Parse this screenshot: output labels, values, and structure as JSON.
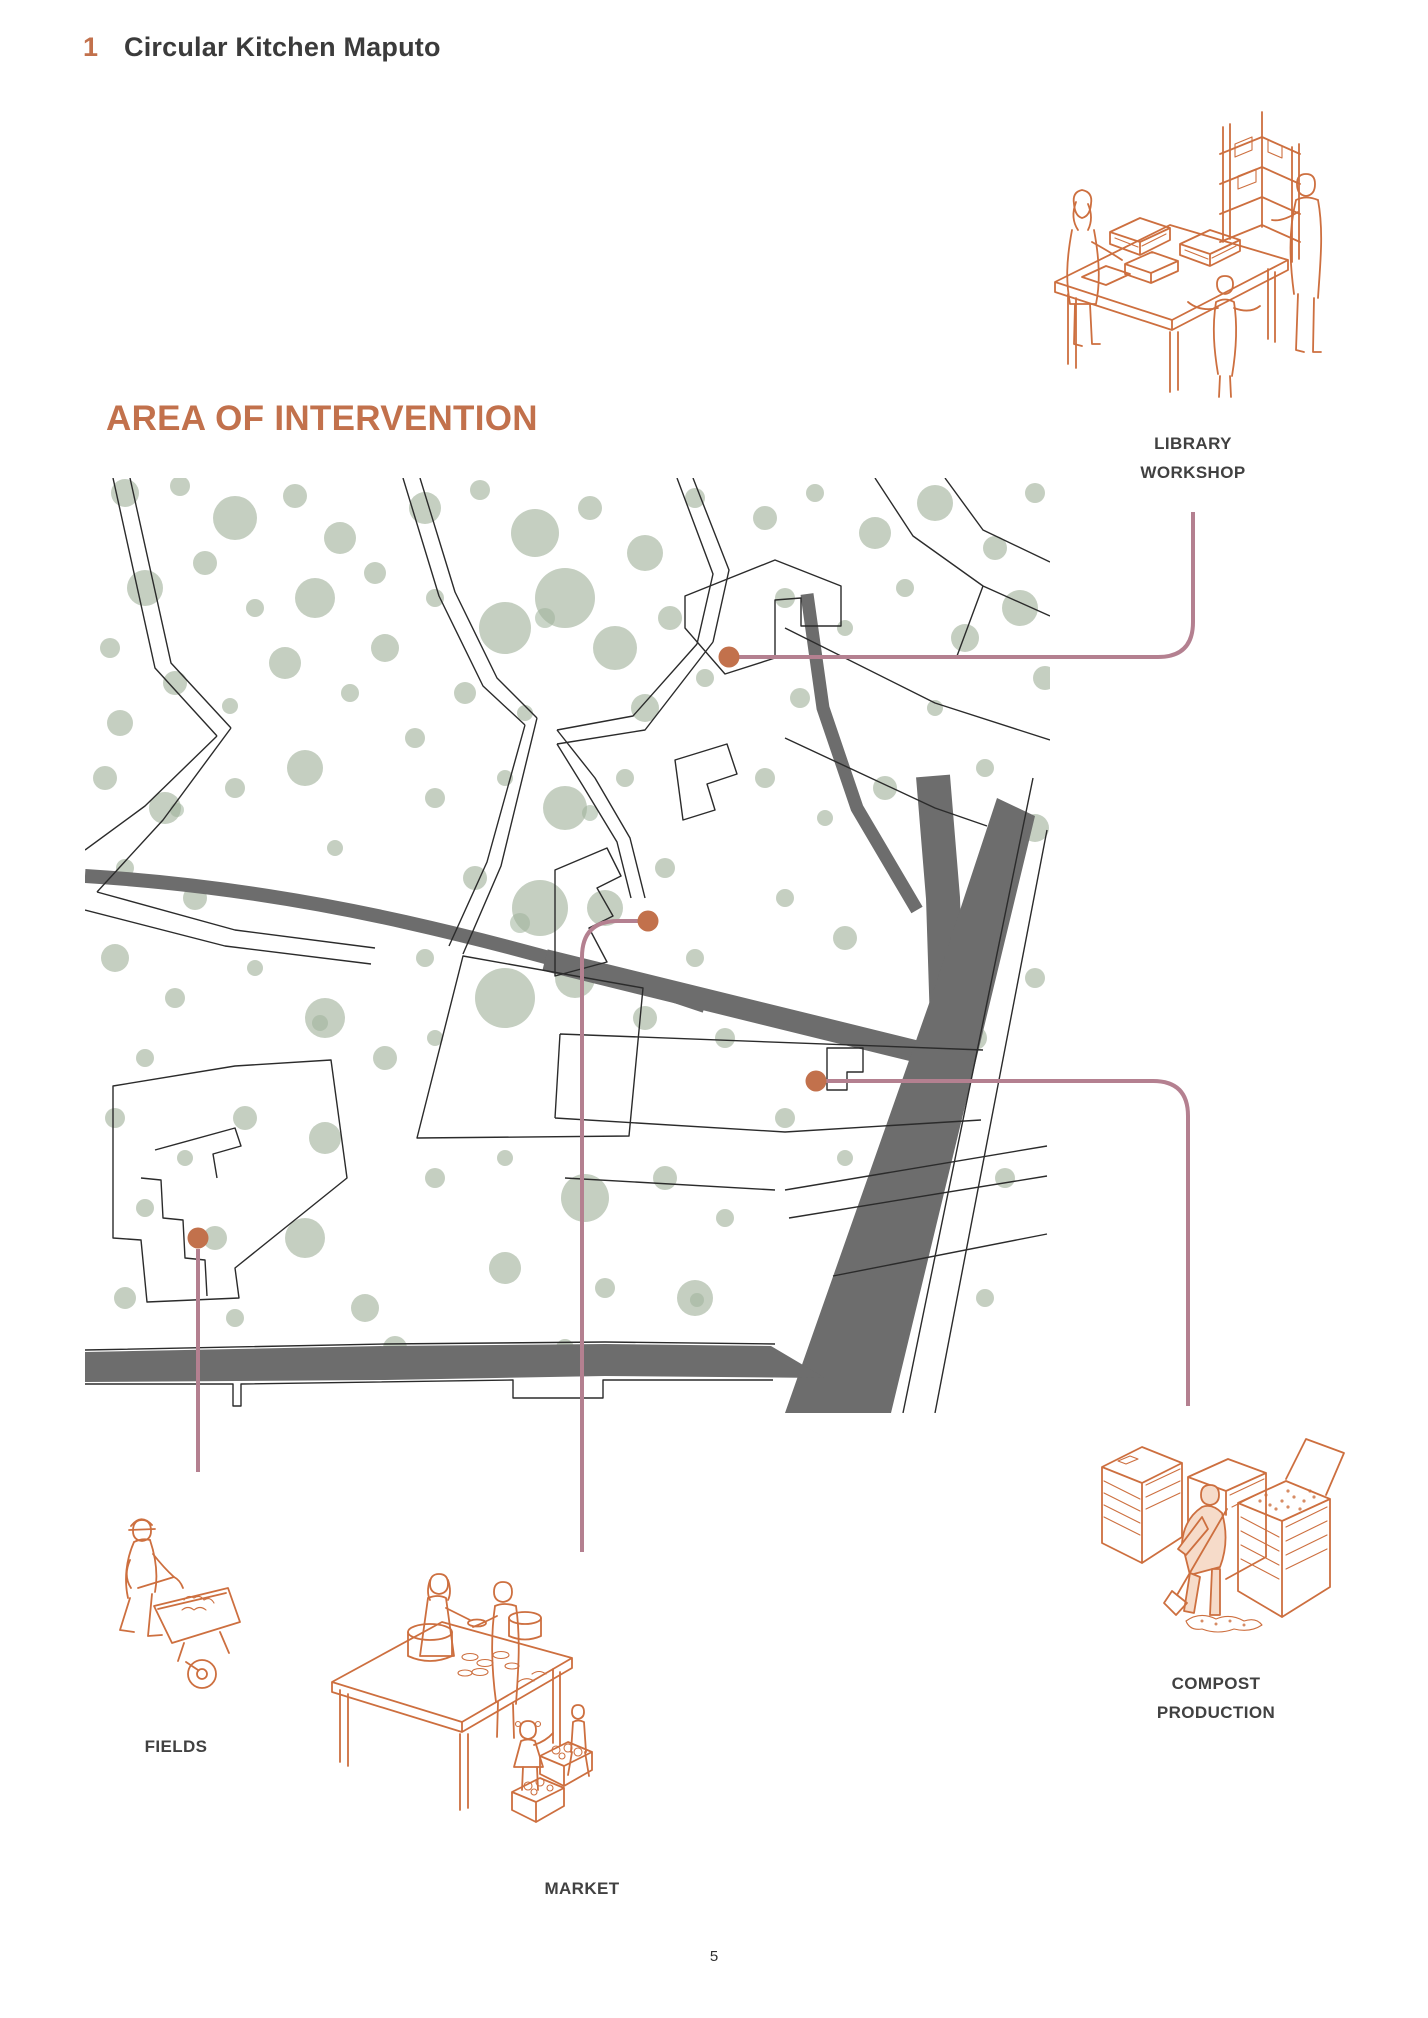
{
  "header": {
    "number": "1",
    "title": "Circular Kitchen Maputo"
  },
  "section_title": "AREA OF INTERVENTION",
  "annotations": {
    "library": {
      "line1": "LIBRARY",
      "line2": "WORKSHOP"
    },
    "fields": {
      "label": "FIELDS"
    },
    "market": {
      "label": "MARKET"
    },
    "compost": {
      "line1": "COMPOST",
      "line2": "PRODUCTION"
    }
  },
  "page_number": "5",
  "colors": {
    "accent": "#C2714C",
    "rose": "#B48090",
    "green": "#B5C2B0",
    "road": "#6D6D6D",
    "street": "#2B2B2B",
    "title": "#3B3B3B",
    "label": "#414141",
    "ill": "#CD6F3F",
    "person": "#F6DBC9",
    "paper": "#FFFFFF"
  }
}
